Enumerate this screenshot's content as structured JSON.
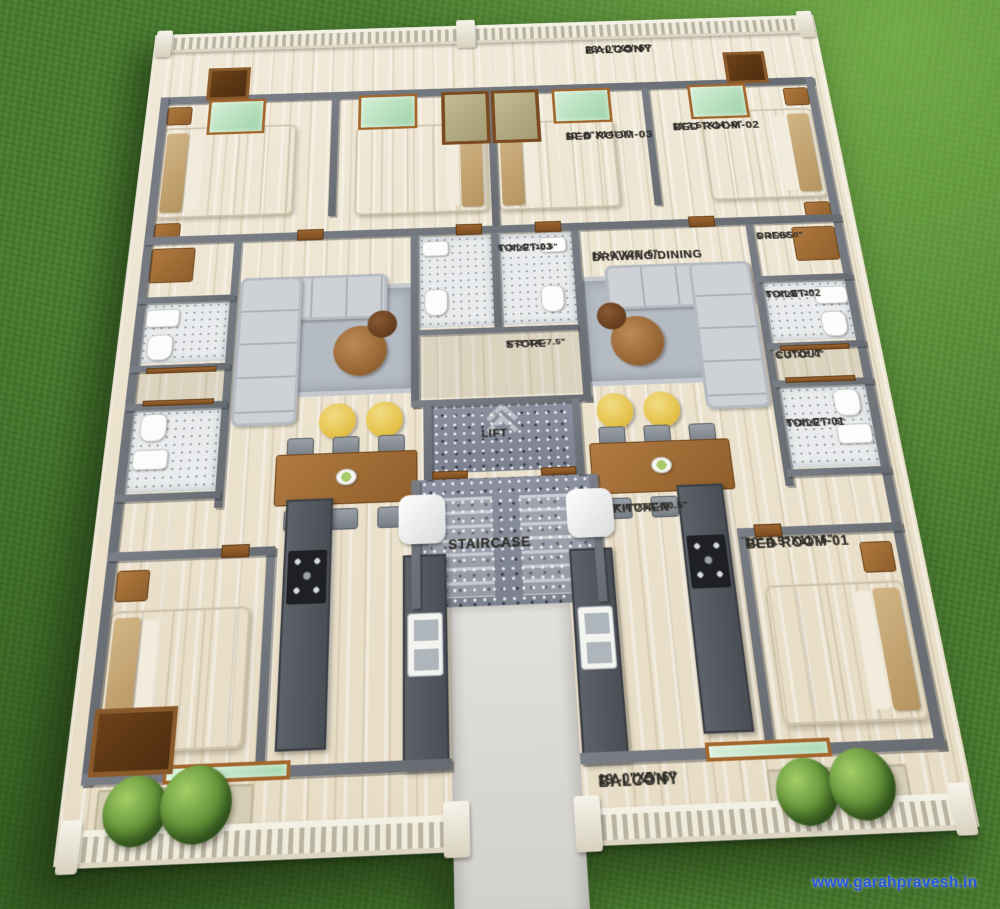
{
  "page": {
    "type": "3d-floor-plan-render",
    "view": "aerial perspective of a two-unit residential floor plan on grass"
  },
  "watermark": {
    "text": "www.garahpravesh.in",
    "color": "#2458dd"
  },
  "palette": {
    "grass": "#467a2c",
    "floor": "#ebe1cd",
    "wall": "#70757c",
    "tile": "#e9ebec",
    "granite": "#878d99",
    "wood": "#9c6530",
    "sofa": "#ced2d7",
    "accent_chair": "#e3bf45",
    "glass_panel": "#b9e2bf",
    "balustrade": "#f3f0e5",
    "watermark_blue": "#2458dd"
  },
  "labels": {
    "balcony_top": {
      "name": "BALCONY",
      "dims": "23'-0\"X5'-6\""
    },
    "bedroom3": {
      "name": "BED ROOM-03",
      "dims": "10'-8\"X14'-0\""
    },
    "bedroom2": {
      "name": "BED ROOM-02",
      "dims": "11'2.5\"X14'-0\""
    },
    "dress": {
      "name": "DRESS",
      "dims": "5'-3\"X5'-0\""
    },
    "toilet3": {
      "name": "TOILET-03",
      "dims": "5'-3\"X7'-10.5\""
    },
    "drawing_dining": {
      "name": "DRAWING/DINING",
      "dims": "11'-0\"X23'-6\""
    },
    "toilet2": {
      "name": "TOILET-02",
      "dims": "5'-3\"X8'-2\""
    },
    "store": {
      "name": "STORE",
      "dims": "5'-3\"X4'-7.5\""
    },
    "cutout": {
      "name": "CUTOUT",
      "dims": "5'-3\"X2'-0\""
    },
    "lift": {
      "name": "LIFT",
      "dims": ""
    },
    "toilet1": {
      "name": "TOILET-01",
      "dims": "5'-3\"X7'-7.5\""
    },
    "staircase": {
      "name": "STAIRCASE",
      "dims": ""
    },
    "kitchen": {
      "name": "KITCHEN",
      "dims": "7'-6\"X11'-10.5\""
    },
    "bedroom1": {
      "name": "BED ROOM-01",
      "dims": "10'-4.5\"X11'-6\""
    },
    "balcony_bottom": {
      "name": "BALCONY",
      "dims": "19'-0\"X5'-6\""
    }
  }
}
